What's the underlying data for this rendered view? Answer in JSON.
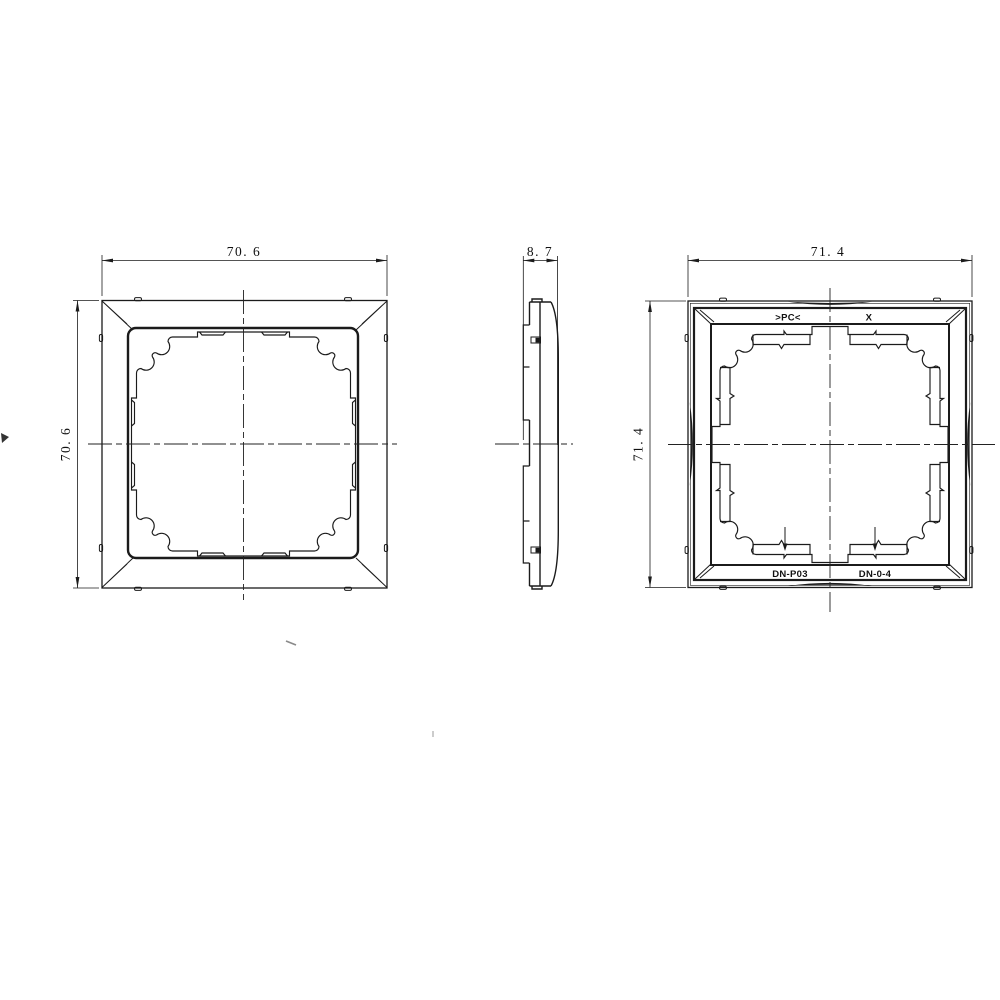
{
  "drawing": {
    "type": "engineering-drawing",
    "part": "single-gang wall plate frame, three orthographic views",
    "line_color": "#1b1b1b",
    "background": "#ffffff"
  },
  "dims": {
    "front_width": "70. 6",
    "front_height": "70. 6",
    "side_thickness": "8. 7",
    "back_width": "71. 4",
    "back_height": "71. 4"
  },
  "labels": {
    "material_top_left": ">PC<",
    "material_top_right": "X",
    "part_no_left": "DN-P03",
    "part_no_right": "DN-0-4"
  }
}
